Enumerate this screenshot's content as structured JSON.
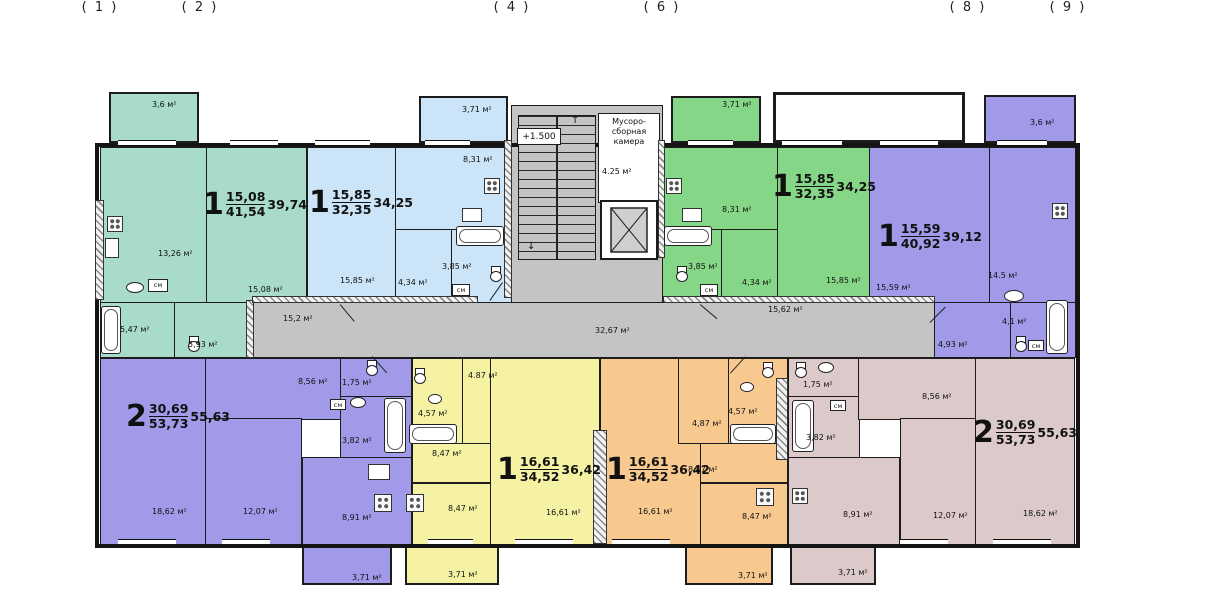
{
  "axis": [
    "( 1 )",
    "( 2 )",
    "( 4 )",
    "( 6 )",
    "( 8 )",
    "( 9 )"
  ],
  "core": {
    "level_mark": "+1.500",
    "trash_room_line1": "Мусоро-",
    "trash_room_line2": "сборная",
    "trash_room_line3": "камера",
    "trash_room_area": "4.25 м²",
    "corridor_left": "15,2 м²",
    "corridor_center": "32,67 м²",
    "corridor_right": "15,62 м²",
    "stair_up_arrow": "↑",
    "stair_down_arrow": "↓"
  },
  "wm_label": "см",
  "apts": {
    "teal": {
      "rooms": "1",
      "living": "15,08",
      "total": "41,54",
      "overall": "39,74",
      "balcony": "3,6 м²",
      "kitchen": "13,26 м²",
      "room": "15,08 м²",
      "bath": "5,47 м²",
      "hall": "5,93 м²"
    },
    "blue": {
      "rooms": "1",
      "living": "15,85",
      "total": "32,35",
      "overall": "34,25",
      "balcony": "3,71 м²",
      "kitchen": "8,31 м²",
      "room": "15,85 м²",
      "hall": "4,34 м²",
      "bath": "3,85 м²"
    },
    "green": {
      "rooms": "1",
      "living": "15,85",
      "total": "32,35",
      "overall": "34,25",
      "balcony": "3,71 м²",
      "kitchen": "8,31 м²",
      "room": "15,85 м²",
      "hall": "4,34 м²",
      "bath": "3,85 м²"
    },
    "violet": {
      "rooms": "1",
      "living": "15,59",
      "total": "40,92",
      "overall": "39,12",
      "balcony": "3,6 м²",
      "kitchen": "14.5 м²",
      "room": "15,59 м²",
      "hall": "4,93 м²",
      "bath": "4,1 м²"
    },
    "violet2": {
      "rooms": "2",
      "living": "30,69",
      "total": "53,73",
      "overall": "55,63",
      "balcony": "3,71 м²",
      "kitchen": "8,91 м²",
      "room1": "18,62 м²",
      "room2": "12,07 м²",
      "hall": "8,56 м²",
      "wc": "1,75 м²",
      "bath": "3,82 м²"
    },
    "yellow": {
      "rooms": "1",
      "living": "16,61",
      "total": "34,52",
      "overall": "36,42",
      "balcony": "3,71 м²",
      "kitchen": "8,47 м²",
      "room": "16,61 м²",
      "hall": "4.87 м²",
      "corridor": "8,47 м²",
      "bath": "4,57 м²"
    },
    "orange": {
      "rooms": "1",
      "living": "16,61",
      "total": "34,52",
      "overall": "36,42",
      "balcony": "3,71 м²",
      "kitchen": "8,47 м²",
      "room": "16,61 м²",
      "hall": "4,87 м²",
      "corridor": "8,47 м²",
      "bath": "4,57 м²"
    },
    "rose": {
      "rooms": "2",
      "living": "30,69",
      "total": "53,73",
      "overall": "55,63",
      "balcony": "3,71 м²",
      "kitchen": "8,91 м²",
      "room1": "18,62 м²",
      "room2": "12,07 м²",
      "hall": "8,56 м²",
      "wc": "1,75 м²",
      "bath": "3,82 м²"
    }
  },
  "colors": {
    "teal": "#a9dbcb",
    "blue": "#cbe4f7",
    "green": "#86d687",
    "violet": "#a09ae9",
    "yellow": "#f5f2a3",
    "orange": "#f8c98f",
    "rose": "#dccaca",
    "corridor_gray": "#c4c4c4",
    "wall": "#141414"
  }
}
